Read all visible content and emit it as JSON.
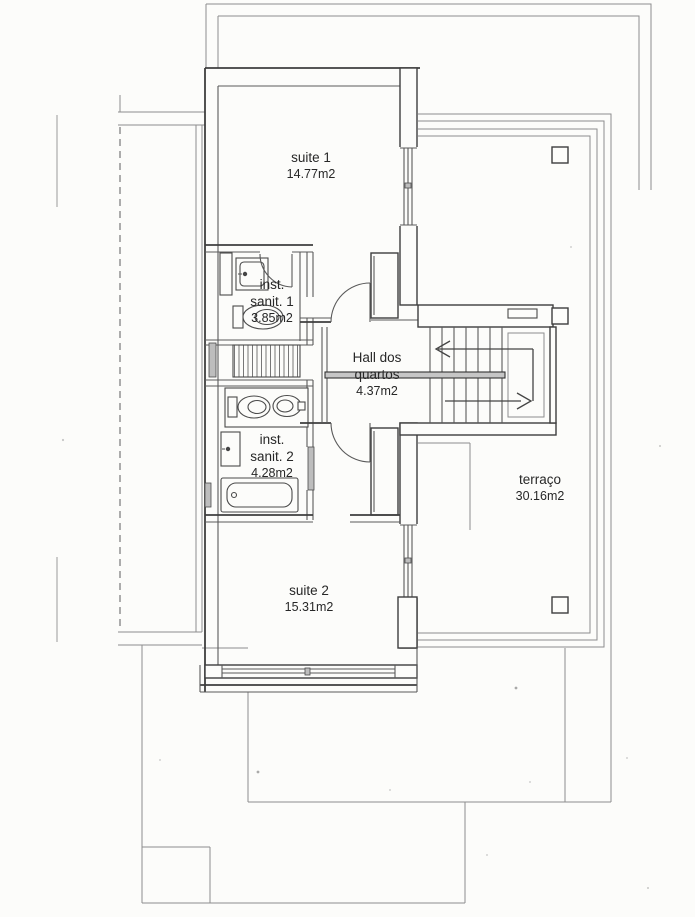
{
  "document": {
    "kind": "architectural floor plan (scanned)",
    "floor": "upper floor / bedrooms level"
  },
  "rooms": {
    "suite1": {
      "name": "suite 1",
      "area": "14.77m2"
    },
    "sanit1": {
      "name_line1": "inst.",
      "name_line2": "sanit. 1",
      "area": "3.85m2"
    },
    "hall": {
      "name_line1": "Hall dos",
      "name_line2": "quartos",
      "area": "4.37m2"
    },
    "sanit2": {
      "name_line1": "inst.",
      "name_line2": "sanit. 2",
      "area": "4.28m2"
    },
    "terraco": {
      "name": "terraço",
      "area": "30.16m2"
    },
    "suite2": {
      "name": "suite 2",
      "area": "15.31m2"
    }
  },
  "colors": {
    "paper": "#fcfcfa",
    "wall_line": "#3e3e3e",
    "thin_line": "#8d8d8d",
    "text": "#272727",
    "handrail_fill": "#c6c6c6"
  }
}
